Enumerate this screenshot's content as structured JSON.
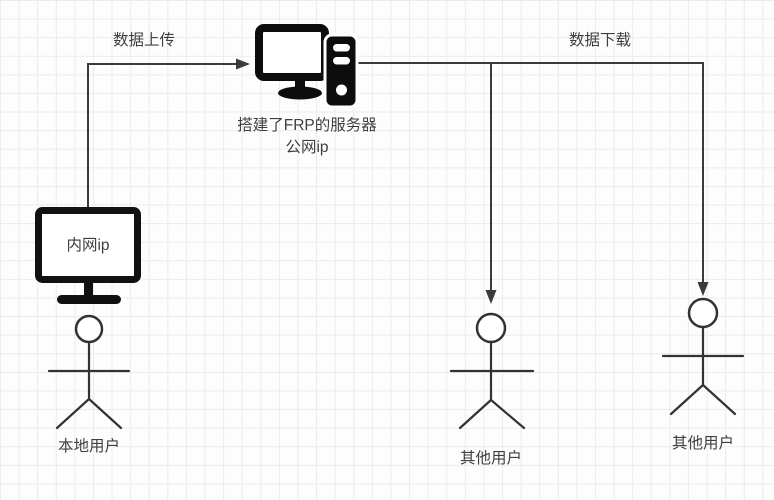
{
  "colors": {
    "icon_fill": "#0d0d0d",
    "connector_line": "#3a3a3a",
    "figure_stroke": "#333333",
    "text": "#3f3f3f",
    "grid_line": "#ebebeb",
    "background": "#fdfdfd"
  },
  "labels": {
    "upload_arrow": "数据上传",
    "download_arrow": "数据下载",
    "frp_server_line1": "搭建了FRP的服务器",
    "frp_server_line2": "公网ip",
    "local_monitor": "内网ip",
    "local_user": "本地用户",
    "other_user_center": "其他用户",
    "other_user_right": "其他用户"
  },
  "structure": {
    "nodes": [
      {
        "id": "local-monitor",
        "type": "monitor-icon",
        "label": "内网ip"
      },
      {
        "id": "local-user",
        "type": "stick-figure",
        "label": "本地用户"
      },
      {
        "id": "frp-server",
        "type": "desktop-server-icon",
        "label": "搭建了FRP的服务器 公网ip"
      },
      {
        "id": "other-user-center",
        "type": "stick-figure",
        "label": "其他用户"
      },
      {
        "id": "other-user-right",
        "type": "stick-figure",
        "label": "其他用户"
      }
    ],
    "edges": [
      {
        "from": "local-monitor",
        "to": "frp-server",
        "label": "数据上传",
        "path": "up-then-right"
      },
      {
        "from": "frp-server",
        "to": "other-user-center",
        "label": "数据下载",
        "path": "right-then-down"
      },
      {
        "from": "frp-server",
        "to": "other-user-right",
        "label": "数据下载",
        "path": "right-then-down"
      }
    ]
  }
}
